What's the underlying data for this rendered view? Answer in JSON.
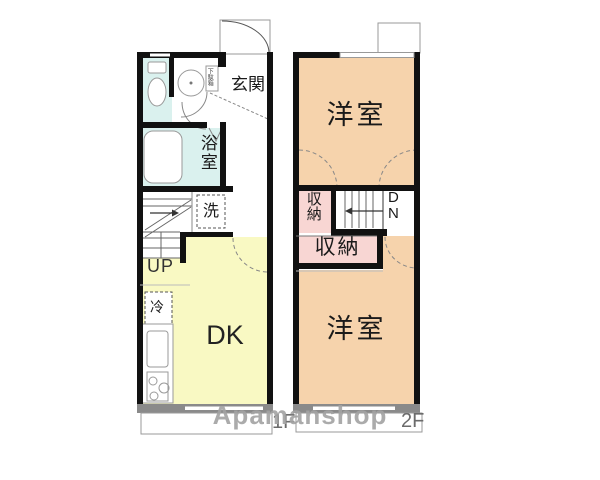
{
  "watermark": "Apamanshop",
  "colors": {
    "wall": "#111111",
    "wet_area": "#daf1ee",
    "kitchen": "#f9f9c3",
    "bedroom": "#f6d3ac",
    "closet": "#f8d6d3",
    "window_wall": "#8a8a8a",
    "white": "#ffffff"
  },
  "floor1": {
    "label": "1F",
    "rooms": {
      "genkan": "玄関",
      "shoe_cabinet": "下駄箱",
      "bathroom": "浴室",
      "laundry": "洗",
      "stairs": "UP",
      "fridge": "冷",
      "dk": "DK"
    }
  },
  "floor2": {
    "label": "2F",
    "rooms": {
      "bedroom_top": "洋室",
      "closet_small": "収納",
      "closet_large": "収納",
      "stairs_d": "D",
      "stairs_n": "N",
      "bedroom_bottom": "洋室"
    }
  }
}
